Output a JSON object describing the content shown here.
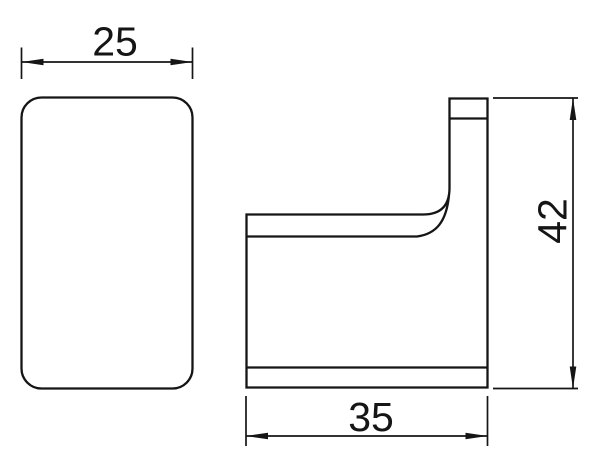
{
  "diagram": {
    "background_color": "#ffffff",
    "line_color": "#151515",
    "dimensions": {
      "width": "25",
      "depth": "35",
      "height": "42"
    }
  }
}
